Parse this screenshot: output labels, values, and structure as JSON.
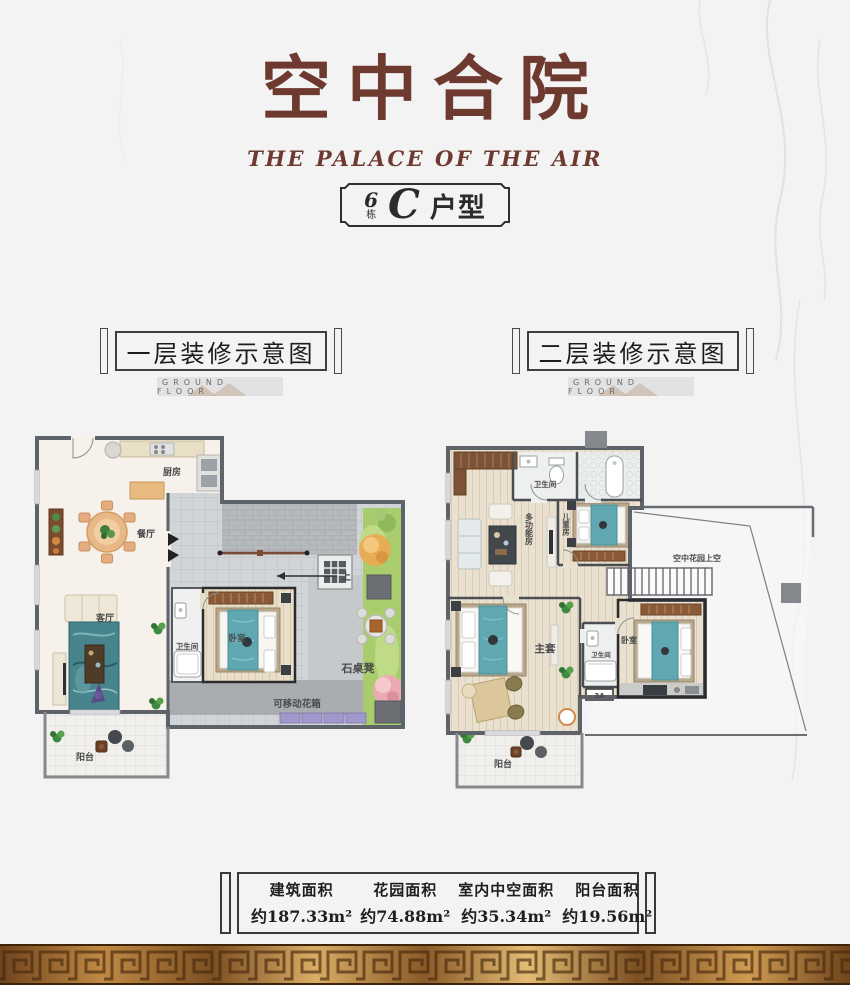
{
  "header": {
    "title": "空中合院",
    "subtitle": "THE PALACE OF THE AIR",
    "badge": {
      "number": "6",
      "unit": "栋",
      "type_letter": "C",
      "type_suffix": "户型"
    }
  },
  "sections": {
    "floor1": {
      "label": "一层装修示意图",
      "sublabel": "GROUND FLOOR"
    },
    "floor2": {
      "label": "二层装修示意图",
      "sublabel": "GROUND FLOOR"
    }
  },
  "floor1": {
    "rooms": {
      "kitchen": "厨房",
      "dining": "餐厅",
      "living": "客厅",
      "bathroom": "卫生间",
      "bedroom": "卧室",
      "stone_table": "石桌凳",
      "movable_planter": "可移动花箱",
      "balcony": "阳台",
      "stairs_up": "上"
    }
  },
  "floor2": {
    "rooms": {
      "bathroom_top": "卫生间",
      "multifunction": "多功能房",
      "kids_room": "儿童房",
      "sky_garden_void": "空中花园上空",
      "master_suite": "主套",
      "bathroom_master": "卫生间",
      "bedroom": "卧室",
      "balcony": "阳台",
      "ac_box": "3A"
    }
  },
  "stats": {
    "items": [
      {
        "label": "建筑面积",
        "value": "约187.33m²"
      },
      {
        "label": "花园面积",
        "value": "约74.88m²"
      },
      {
        "label": "室内中空面积",
        "value": "约35.34m²"
      },
      {
        "label": "阳台面积",
        "value": "约19.56m²"
      }
    ]
  },
  "colors": {
    "title_brown": "#6e3a30",
    "wall_gray": "#5e6269",
    "bed_teal": "#5fa8b2",
    "garden_green": "#a9cd6d",
    "gold_border": "#c99350"
  }
}
